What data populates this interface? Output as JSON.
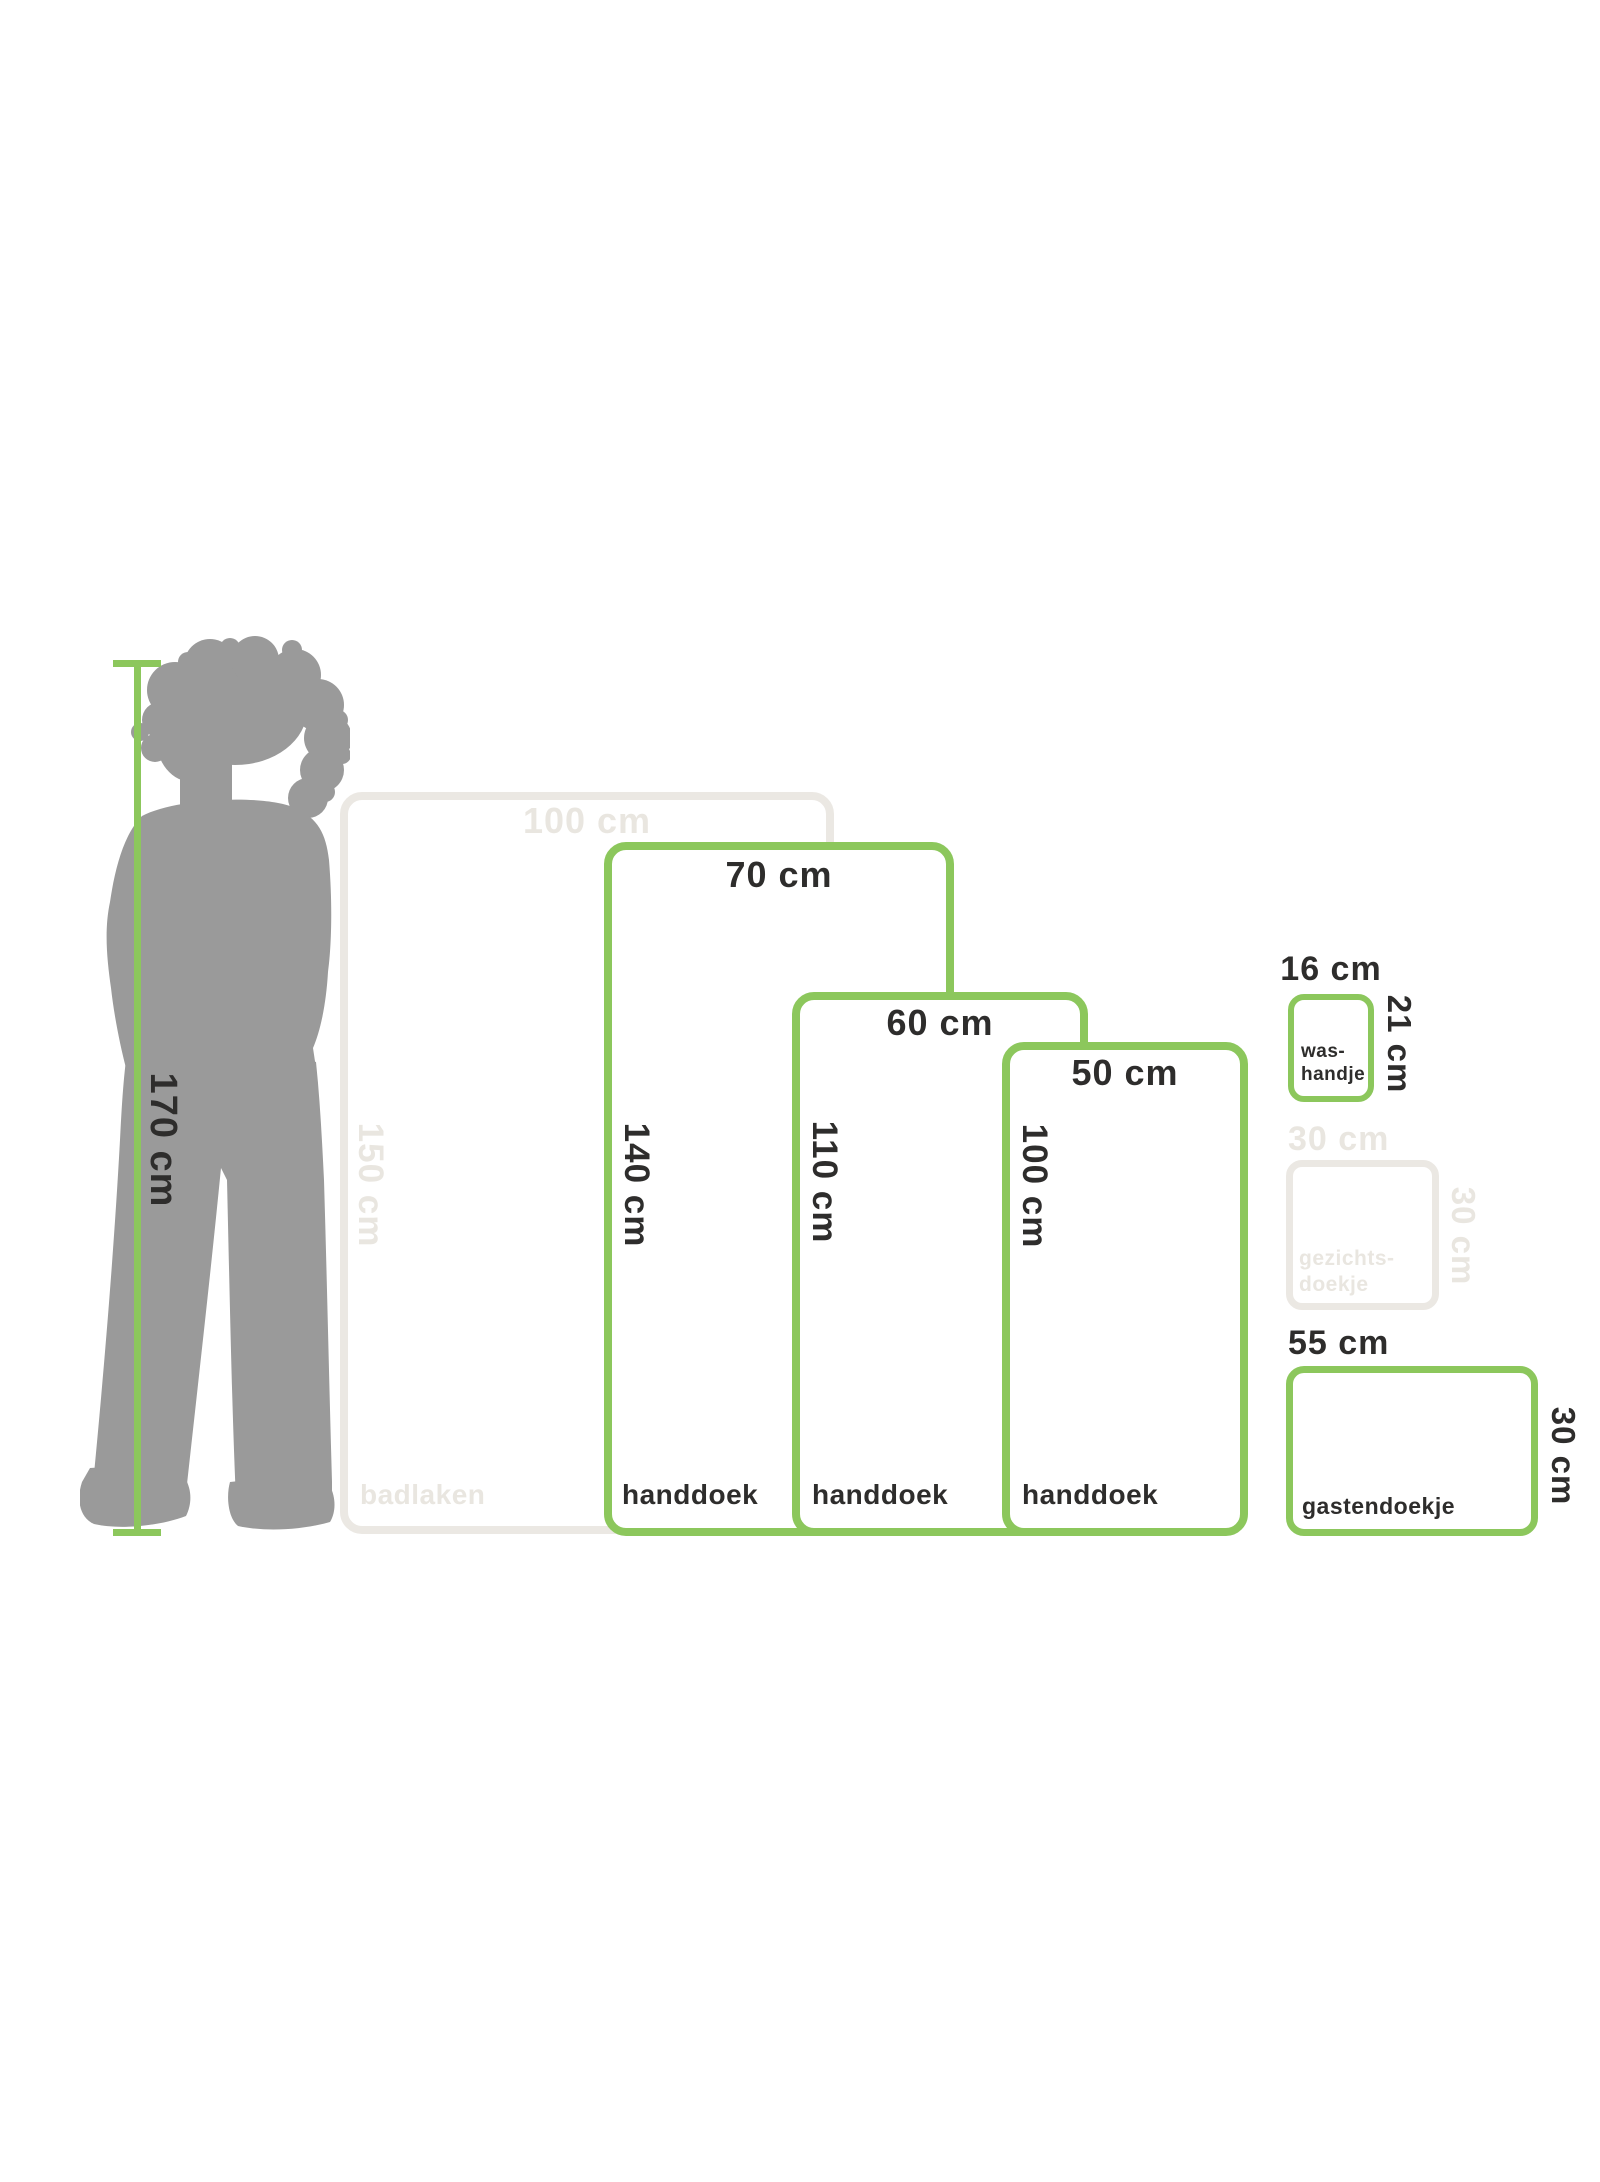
{
  "title": "towel size comparison diagram",
  "colors": {
    "green": "#8CC75C",
    "muted_gray": "#EBE8E3",
    "text_dark": "#2E2D2C",
    "silhouette_gray": "#9A9A9A"
  },
  "person": {
    "height_label": "170 cm"
  },
  "items": [
    {
      "id": "badlaken",
      "name": "badlaken",
      "name_line2": "",
      "width_label": "100 cm",
      "height_label": "150 cm",
      "variant": "muted"
    },
    {
      "id": "handdoek-groot",
      "name": "handdoek",
      "name_line2": "",
      "width_label": "70 cm",
      "height_label": "140 cm",
      "variant": "green"
    },
    {
      "id": "handdoek-middel",
      "name": "handdoek",
      "name_line2": "",
      "width_label": "60 cm",
      "height_label": "110 cm",
      "variant": "green"
    },
    {
      "id": "handdoek-klein",
      "name": "handdoek",
      "name_line2": "",
      "width_label": "50 cm",
      "height_label": "100 cm",
      "variant": "green"
    },
    {
      "id": "washandje",
      "name": "was-",
      "name_line2": "handje",
      "width_label": "16 cm",
      "height_label": "21 cm",
      "variant": "green"
    },
    {
      "id": "gezichtsdoekje",
      "name": "gezichts-",
      "name_line2": "doekje",
      "width_label": "30 cm",
      "height_label": "30 cm",
      "variant": "muted"
    },
    {
      "id": "gastendoekje",
      "name": "gastendoekje",
      "name_line2": "",
      "width_label": "55 cm",
      "height_label": "30 cm",
      "variant": "green"
    }
  ]
}
